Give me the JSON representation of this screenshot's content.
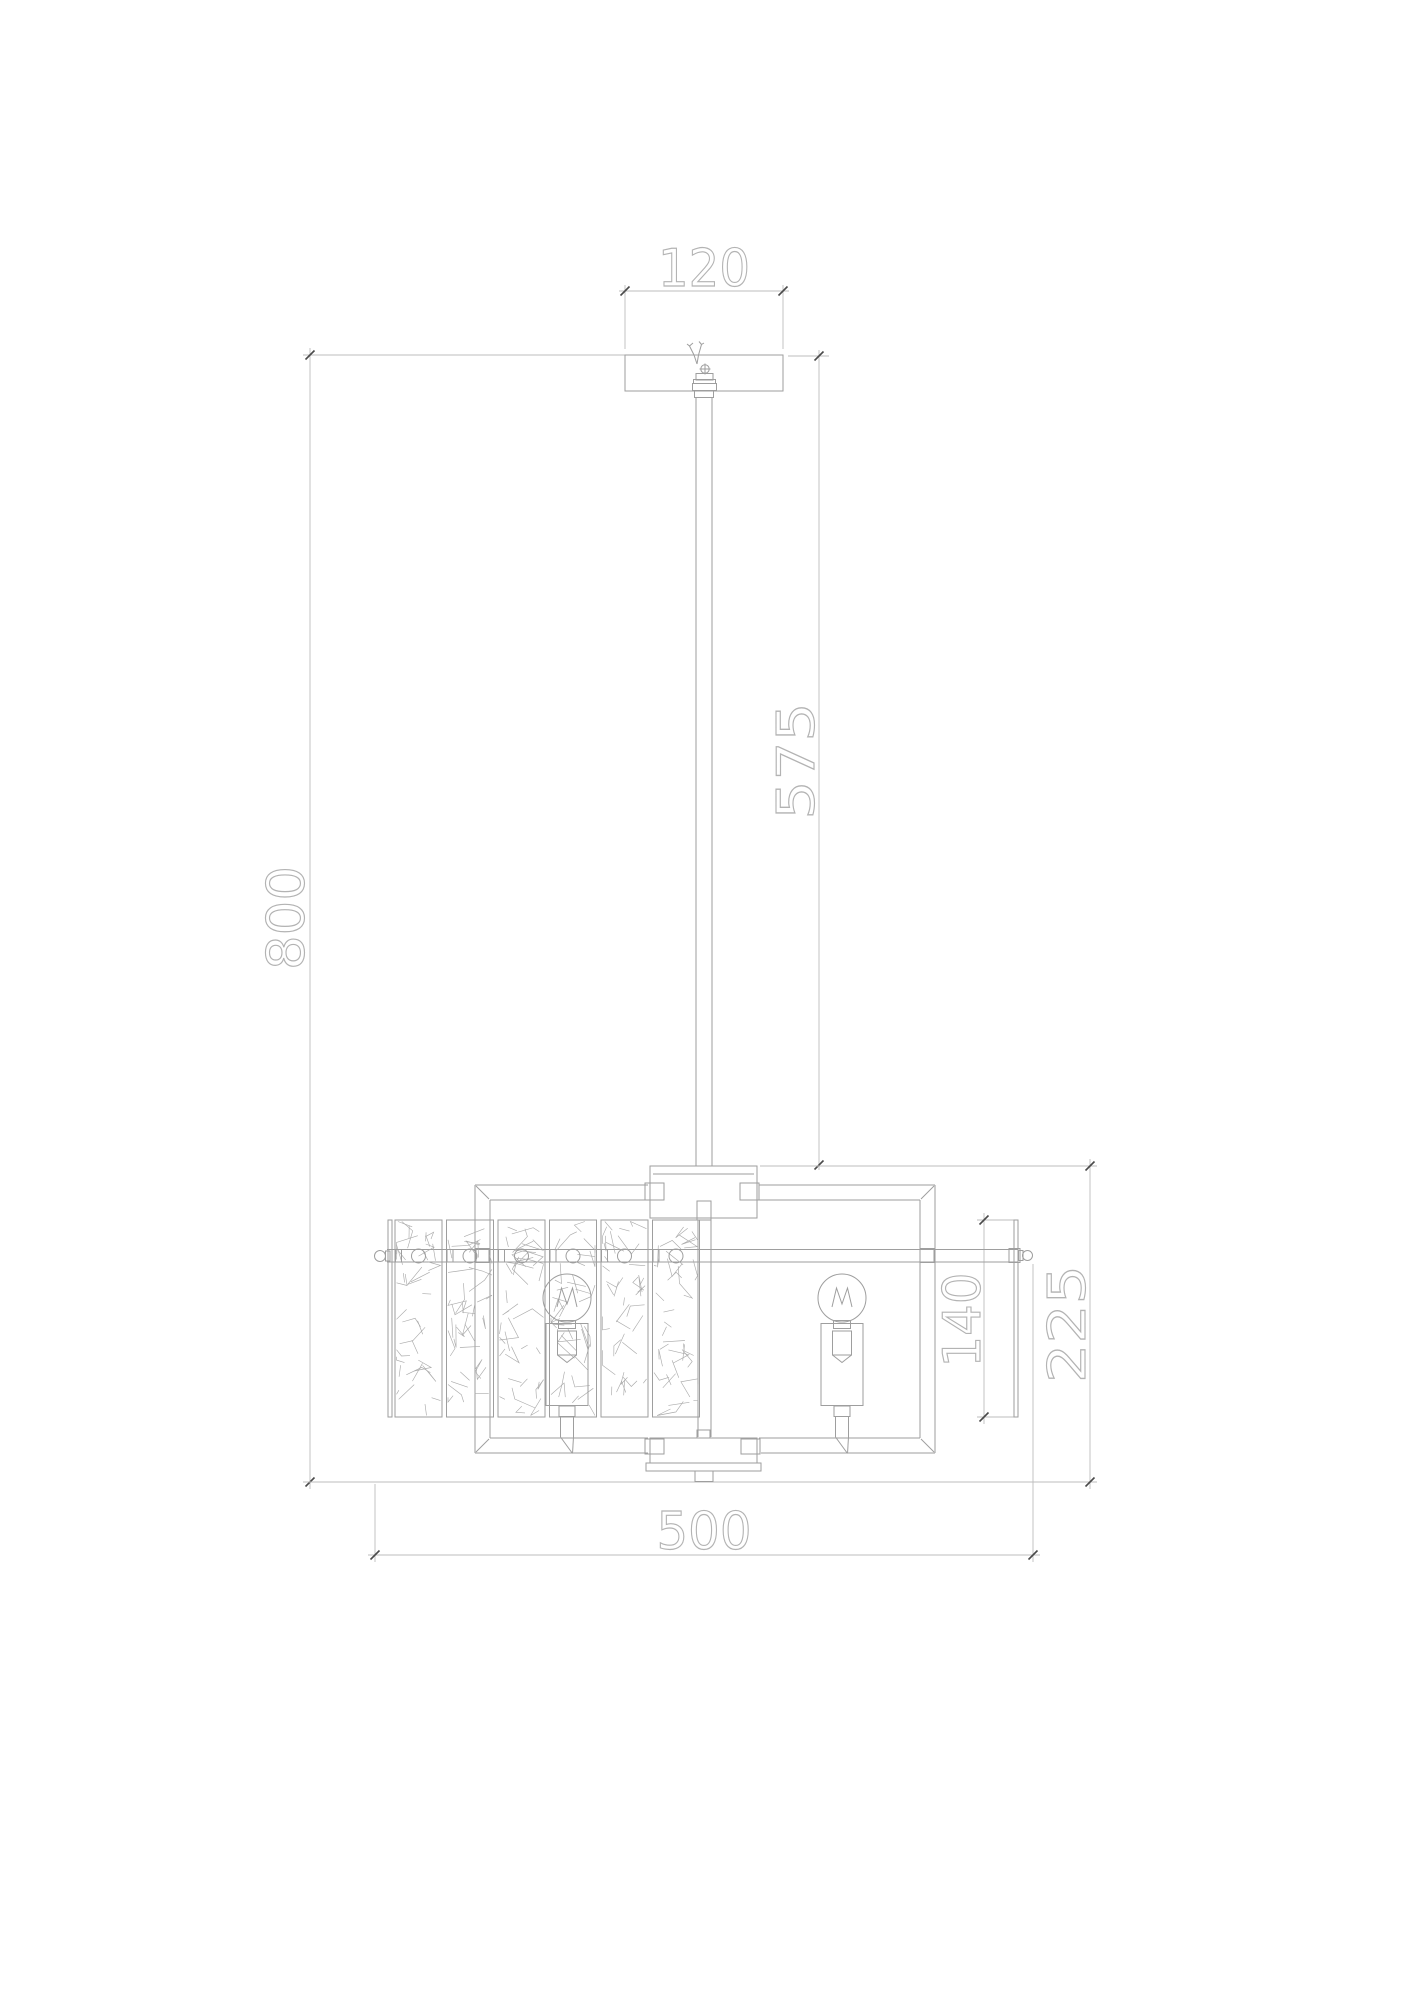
{
  "drawing": {
    "type": "technical-dimension-drawing",
    "subject": "pendant chandelier with crystal panels, front elevation",
    "dimension_labels": {
      "canopy_width": "120",
      "overall_height": "800",
      "stem_length": "575",
      "overall_width": "500",
      "panel_height": "140",
      "body_height": "225"
    },
    "colors": {
      "line": "#9e9e9e",
      "dim_line": "#bdbdbd",
      "tick": "#4a4a4a",
      "text_outline": "#b3b3b3",
      "texture": "#ababab",
      "background": "#ffffff"
    }
  }
}
